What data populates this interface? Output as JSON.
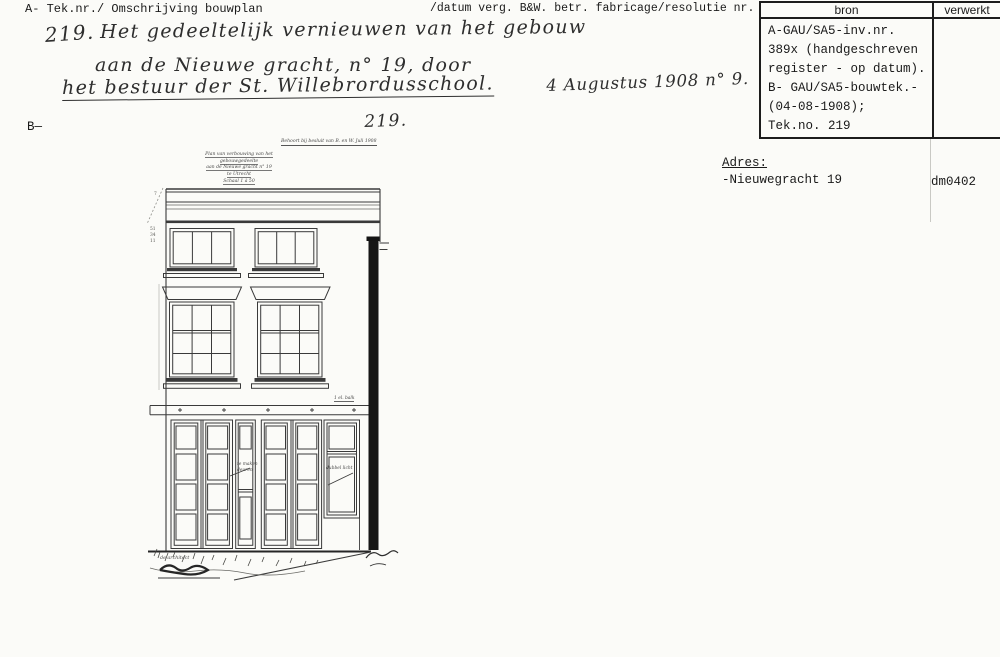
{
  "header": {
    "left": "A- Tek.nr./ Omschrijving bouwplan",
    "right": "/datum verg. B&W. betr. fabricage/resolutie nr."
  },
  "register_table": {
    "col_bron": "bron",
    "col_verwerkt": "verwerkt",
    "bron_lines": [
      "A-GAU/SA5-inv.nr.",
      "389x (handgeschreven",
      "register - op datum).",
      "B- GAU/SA5-bouwtek.-",
      "(04-08-1908);",
      "Tek.no. 219"
    ],
    "verwerkt_value": ""
  },
  "address": {
    "label": "Adres:",
    "value": "-Nieuwegracht 19"
  },
  "scan_code": "dm0402",
  "margin_mark": "B—",
  "handwritten": {
    "number": "219.",
    "line1": "Het gedeeltelijk vernieuwen van het gebouw",
    "line2": "aan de Nieuwe gracht, n° 19, door",
    "line3": "het bestuur der St. Willebrordusschool.",
    "line3_date": "4 Augustus 1908 n° 9.",
    "number_repeat": "219."
  },
  "drawing": {
    "approval_note": "Behoort bij besluit van B. en W.  Juli 1908",
    "title_lines": [
      "Plan van verbouwing van het gebouwgedeelte",
      "aan de Nieuwe gracht n° 19",
      "te Utrecht",
      "Schaal 1 à 50"
    ],
    "beam_note": "1 el. balk",
    "door_note_line1": "te maken",
    "door_note_line2": "deuren",
    "window_note": "dubbel licht",
    "architect_note": "de architect"
  }
}
